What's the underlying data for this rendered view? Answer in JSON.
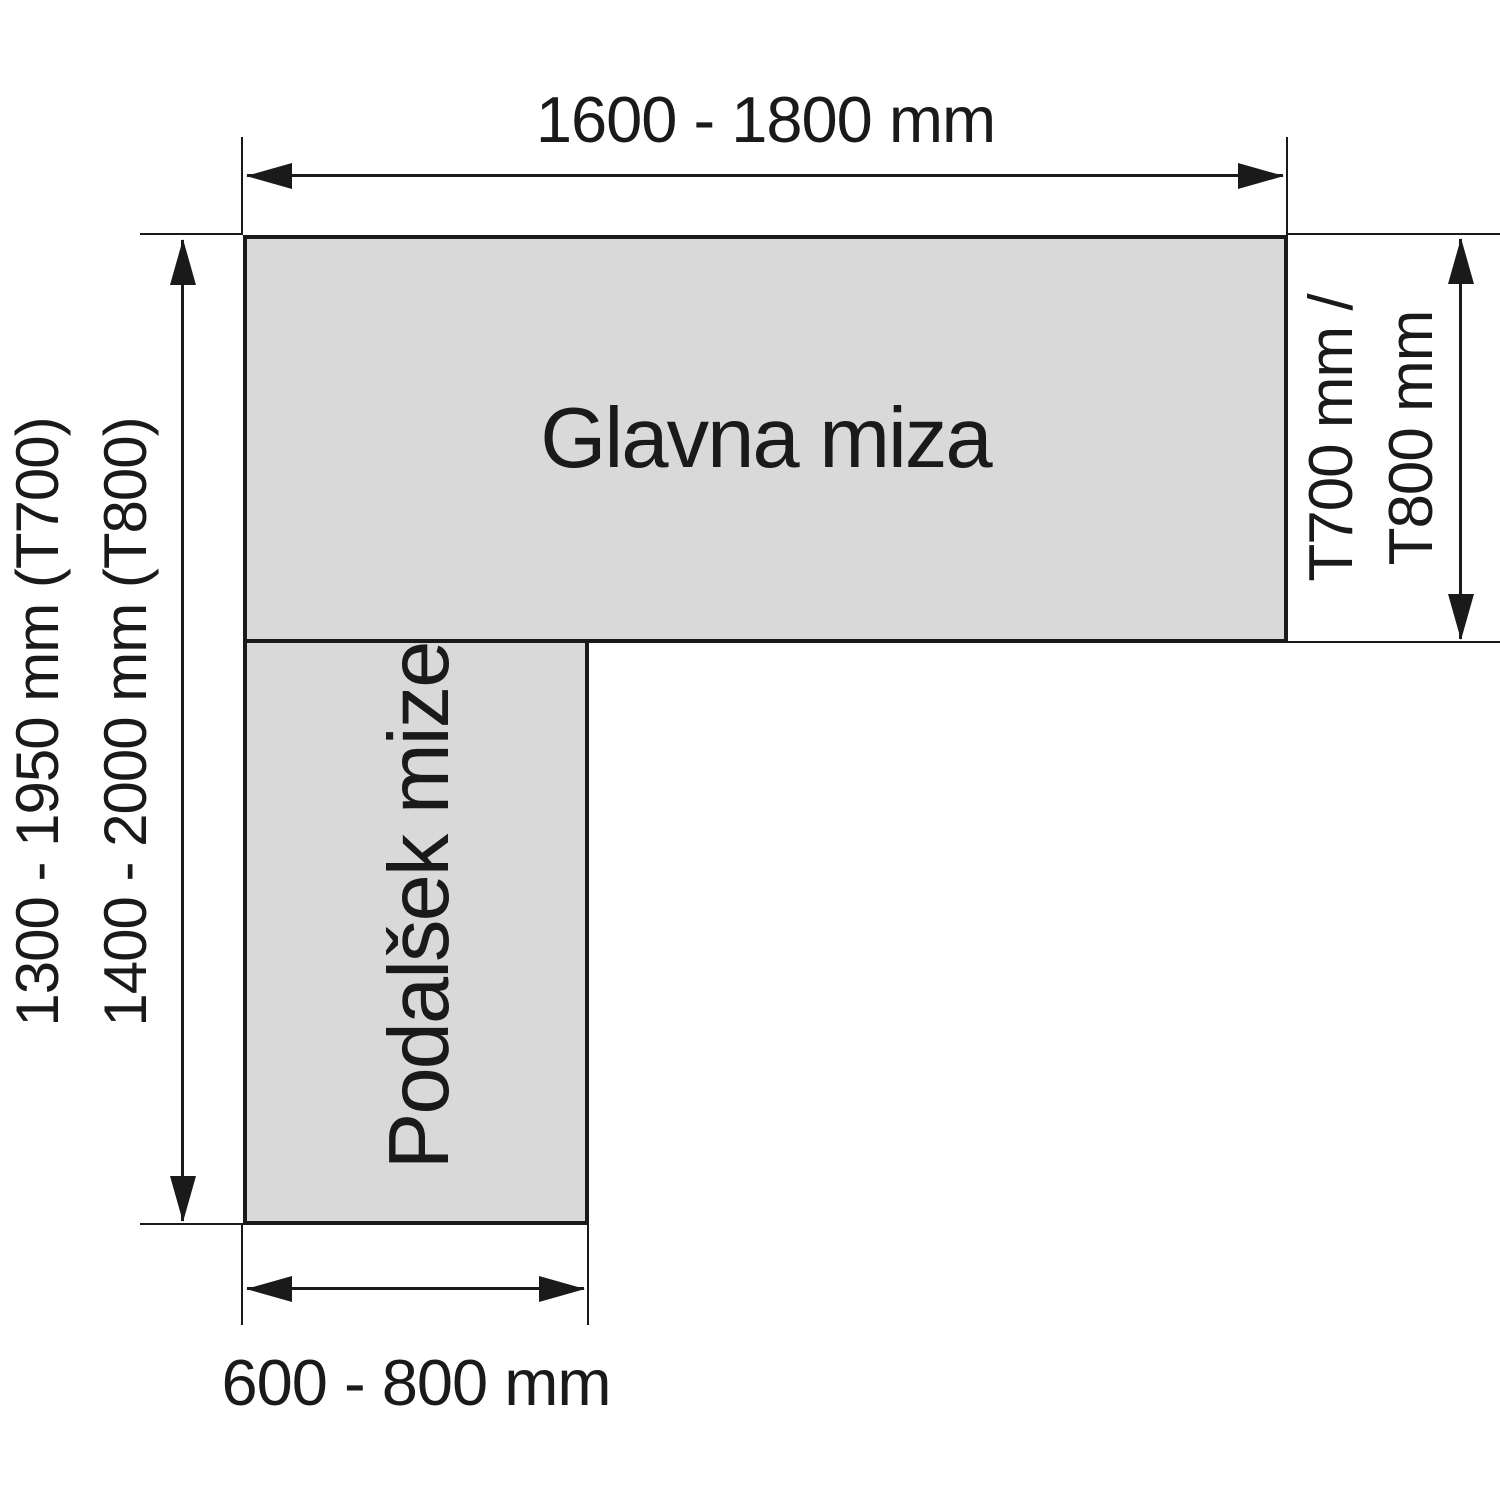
{
  "colors": {
    "line": "#1a1a1a",
    "table_fill": "#d9d9d9",
    "bg": "#ffffff"
  },
  "main_table": {
    "label": "Glavna miza",
    "width_dimension": "1600 - 1800 mm",
    "depth_dimension_line1": "T700 mm /",
    "depth_dimension_line2": "T800 mm"
  },
  "extension_table": {
    "label": "Podalšek mize",
    "width_dimension": "600 - 800 mm"
  },
  "overall_length": {
    "line1": "1300 - 1950 mm (T700)",
    "line2": "1400 - 2000 mm (T800)"
  }
}
